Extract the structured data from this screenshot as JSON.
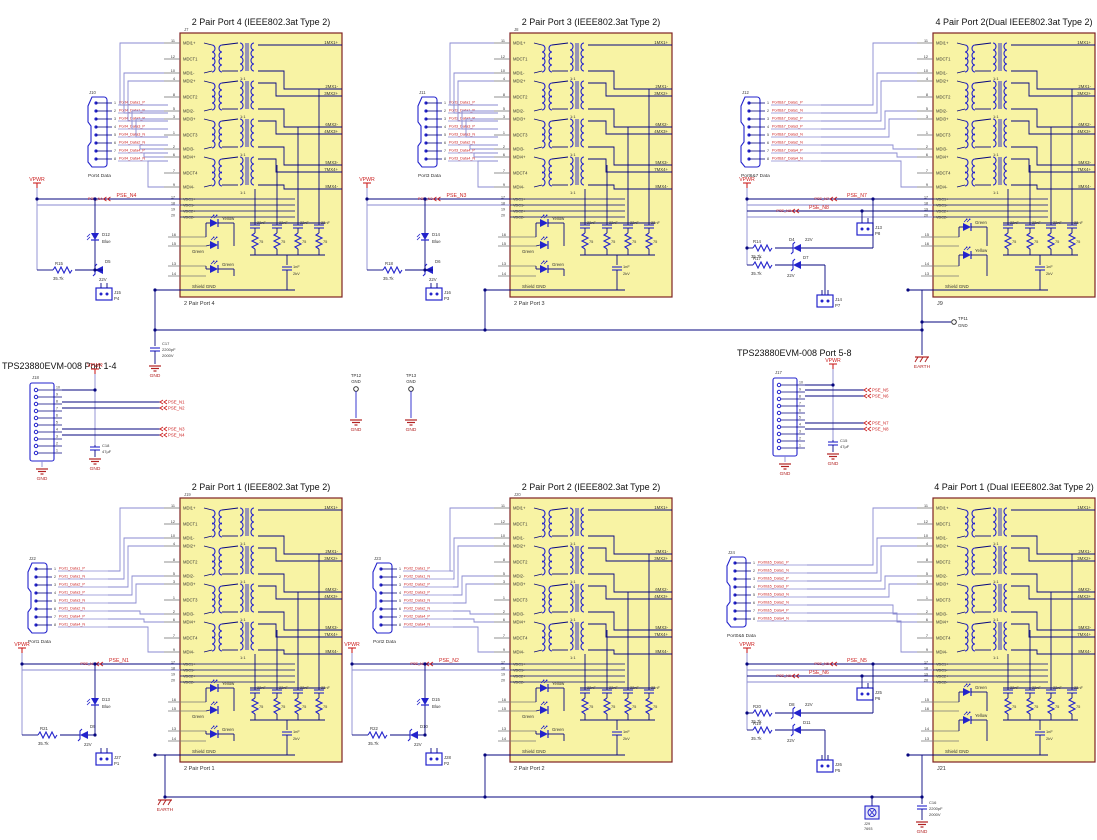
{
  "colors": {
    "block_fill": "#F8F3A4",
    "block_border": "#7E2222",
    "wire": "#8A8AD0",
    "wire_dark": "#06067F",
    "part": "#2323CC",
    "net": "#CC2222",
    "text": "#333333",
    "title": "#111111",
    "red": "#B22222"
  },
  "shared": {
    "mdi_pins": [
      [
        "11",
        "MDI1+"
      ],
      [
        "12",
        "MDCT1"
      ],
      [
        "10",
        "MDI1-"
      ],
      [
        "4",
        "MDI2+"
      ],
      [
        "8",
        "MDCT2"
      ],
      [
        "5",
        "MDI2-"
      ],
      [
        "3",
        "MDI3+"
      ],
      [
        "1",
        "MDCT3"
      ],
      [
        "2",
        "MDI3-"
      ],
      [
        "6",
        "MDI4+"
      ],
      [
        "7",
        "MDCT4"
      ],
      [
        "9",
        "MDI4-"
      ]
    ],
    "vdc_pins": [
      [
        "17",
        "VDC1+"
      ],
      [
        "18",
        "VDC1-"
      ],
      [
        "19",
        "VDC2+"
      ],
      [
        "20",
        "VDC2-"
      ]
    ],
    "mx_labels": [
      "1MX1+",
      "2MX1-",
      "3MX2+",
      "6MX2-",
      "4MX3+",
      "5MX3-",
      "7MX4+",
      "8MX4-"
    ],
    "ratio": "1:1",
    "cap_value": "22nF",
    "term_value": "75",
    "bulk_value": [
      "1nF",
      "2kV"
    ],
    "shield": "Shield GND",
    "gnd": "GND",
    "earth": "EARTH",
    "vpwr": "VPWR",
    "conn_pin_nums": [
      "1",
      "2",
      "3",
      "4",
      "5",
      "6",
      "7",
      "8"
    ],
    "module_pin_nums": [
      "10",
      "9",
      "8",
      "7",
      "6",
      "5",
      "4",
      "3",
      "2",
      "1"
    ]
  },
  "blocks": [
    {
      "title": "2 Pair Port 4 (IEEE802.3at Type 2)",
      "ref": "J7",
      "footer": "2 Pair Port 4",
      "led_groups": [
        {
          "colors": [
            "Yellow",
            "Green"
          ],
          "pins": [
            "16",
            "15"
          ]
        },
        {
          "colors": [
            "Green"
          ],
          "pins": [
            "13",
            "14"
          ]
        }
      ],
      "connector": {
        "ref": "J10",
        "label": "Port4 Data",
        "nets": [
          "Port4_Data1_P",
          "Port4_Data1_N",
          "Port4_Data2_P",
          "Port4_Data3_P",
          "Port4_Data3_N",
          "Port4_Data2_N",
          "Port4_Data4_P",
          "Port4_Data4_N"
        ]
      },
      "side": {
        "flags": [
          "PSE_N4"
        ],
        "resistors": [
          [
            "R15",
            "35.7k"
          ]
        ],
        "zeners": [
          [
            "D5",
            "22V"
          ]
        ],
        "led": [
          "D12",
          "Blue"
        ],
        "jumpers": [
          [
            "J15",
            "P4"
          ]
        ]
      }
    },
    {
      "title": "2 Pair Port 3 (IEEE802.3at Type 2)",
      "ref": "J8",
      "footer": "2 Pair Port 3",
      "led_groups": [
        {
          "colors": [
            "Yellow",
            "Green"
          ],
          "pins": [
            "16",
            "15"
          ]
        },
        {
          "colors": [
            "Green"
          ],
          "pins": [
            "13",
            "14"
          ]
        }
      ],
      "connector": {
        "ref": "J11",
        "label": "Port3 Data",
        "nets": [
          "Port3_Data1_P",
          "Port3_Data1_N",
          "Port3_Data2_P",
          "Port3_Data3_P",
          "Port3_Data3_N",
          "Port3_Data2_N",
          "Port3_Data4_P",
          "Port3_Data4_N"
        ]
      },
      "side": {
        "flags": [
          "PSE_N3"
        ],
        "resistors": [
          [
            "R18",
            "35.7k"
          ]
        ],
        "zeners": [
          [
            "D6",
            "22V"
          ]
        ],
        "led": [
          "D14",
          "Blue"
        ],
        "jumpers": [
          [
            "J16",
            "P3"
          ]
        ]
      }
    },
    {
      "title": "4 Pair Port 2(Dual IEEE802.3at Type 2)",
      "ref": "",
      "footer": "J9",
      "led_groups": [
        {
          "colors": [
            "Green"
          ],
          "pins": [
            "15",
            "16"
          ]
        },
        {
          "colors": [
            "Yellow"
          ],
          "pins": [
            "14",
            "13"
          ]
        }
      ],
      "connector": {
        "ref": "J12",
        "label": "Port6&7 Data",
        "nets": [
          "Port6&7_Data1_P",
          "Port6&7_Data1_N",
          "Port6&7_Data2_P",
          "Port6&7_Data3_P",
          "Port6&7_Data3_N",
          "Port6&7_Data2_N",
          "Port6&7_Data4_P",
          "Port6&7_Data4_N"
        ]
      },
      "side": {
        "flags": [
          "PSE_N7",
          "PSE_N8"
        ],
        "resistors": [
          [
            "R14",
            "35.7k"
          ],
          [
            "R17",
            "35.7k"
          ]
        ],
        "zeners": [
          [
            "D4",
            "22V"
          ],
          [
            "D7",
            "22V"
          ]
        ],
        "led": null,
        "jumpers": [
          [
            "J13",
            "P8"
          ],
          [
            "J14",
            "P7"
          ]
        ]
      }
    },
    {
      "title": "2 Pair Port 1 (IEEE802.3at Type 2)",
      "ref": "J19",
      "footer": "2 Pair Port 1",
      "led_groups": [
        {
          "colors": [
            "Yellow",
            "Green"
          ],
          "pins": [
            "16",
            "15"
          ]
        },
        {
          "colors": [
            "Green"
          ],
          "pins": [
            "13",
            "14"
          ]
        }
      ],
      "connector": {
        "ref": "J22",
        "label": "Port1 Data",
        "nets": [
          "Port1_Data1_P",
          "Port1_Data1_N",
          "Port1_Data2_P",
          "Port1_Data3_P",
          "Port1_Data3_N",
          "Port1_Data2_N",
          "Port1_Data4_P",
          "Port1_Data4_N"
        ]
      },
      "side": {
        "flags": [
          "PSE_N1"
        ],
        "resistors": [
          [
            "R21",
            "35.7k"
          ]
        ],
        "zeners": [
          [
            "D9",
            "22V"
          ]
        ],
        "led": [
          "D13",
          "Blue"
        ],
        "jumpers": [
          [
            "J27",
            "P1"
          ]
        ]
      }
    },
    {
      "title": "2 Pair Port 2 (IEEE802.3at Type 2)",
      "ref": "J20",
      "footer": "2 Pair Port 2",
      "led_groups": [
        {
          "colors": [
            "Yellow",
            "Green"
          ],
          "pins": [
            "16",
            "15"
          ]
        },
        {
          "colors": [
            "Green"
          ],
          "pins": [
            "13",
            "14"
          ]
        }
      ],
      "connector": {
        "ref": "J23",
        "label": "Port2 Data",
        "nets": [
          "Port2_Data1_P",
          "Port2_Data1_N",
          "Port2_Data2_P",
          "Port2_Data3_P",
          "Port2_Data3_N",
          "Port2_Data2_N",
          "Port2_Data4_P",
          "Port2_Data4_N"
        ]
      },
      "side": {
        "flags": [
          "PSE_N2"
        ],
        "resistors": [
          [
            "R22",
            "35.7k"
          ]
        ],
        "zeners": [
          [
            "D10",
            "22V"
          ]
        ],
        "led": [
          "D15",
          "Blue"
        ],
        "jumpers": [
          [
            "J28",
            "P2"
          ]
        ]
      }
    },
    {
      "title": "4 Pair Port 1 (Dual IEEE802.3at Type 2)",
      "ref": "",
      "footer": "J21",
      "led_groups": [
        {
          "colors": [
            "Green"
          ],
          "pins": [
            "15",
            "16"
          ]
        },
        {
          "colors": [
            "Yellow"
          ],
          "pins": [
            "14",
            "13"
          ]
        }
      ],
      "connector": {
        "ref": "J24",
        "label": "Port0&5 Data",
        "nets": [
          "Port0&5_Data1_P",
          "Port0&5_Data1_N",
          "Port0&5_Data2_P",
          "Port0&5_Data3_P",
          "Port0&5_Data3_N",
          "Port0&5_Data2_N",
          "Port0&5_Data4_P",
          "Port0&5_Data4_N"
        ]
      },
      "side": {
        "flags": [
          "PSE_N5",
          "PSE_N6"
        ],
        "resistors": [
          [
            "R20",
            "35.7k"
          ],
          [
            "R19",
            "35.7k"
          ]
        ],
        "zeners": [
          [
            "D8",
            "22V"
          ],
          [
            "D11",
            "22V"
          ]
        ],
        "led": null,
        "jumpers": [
          [
            "J25",
            "P6"
          ],
          [
            "J26",
            "P5"
          ]
        ]
      }
    }
  ],
  "modules": {
    "left": {
      "title": "TPS23880EVM-008 Port 1-4",
      "ref": "J18",
      "flags": [
        "PSE_N1",
        "PSE_N2",
        "PSE_N3",
        "PSE_N4"
      ],
      "cap_ref": "C18",
      "cap_val": "47µF"
    },
    "right": {
      "title": "TPS23880EVM-008 Port 5-8",
      "ref": "J17",
      "flags": [
        "PSE_N5",
        "PSE_N6",
        "PSE_N7",
        "PSE_N8"
      ],
      "cap_ref": "C15",
      "cap_val": "47µF"
    }
  },
  "test_points": {
    "tp12": {
      "ref": "TP12",
      "label": "GND"
    },
    "tp13": {
      "ref": "TP13",
      "label": "GND"
    },
    "tp11": {
      "ref": "TP11",
      "label": "GND"
    }
  },
  "hv_caps": {
    "c17": {
      "ref": "C17",
      "v1": "2200pF",
      "v2": "2000V"
    },
    "c16": {
      "ref": "C16",
      "v1": "2200pF",
      "v2": "2000V"
    }
  },
  "screw": {
    "ref": "J29",
    "val": "7693"
  }
}
